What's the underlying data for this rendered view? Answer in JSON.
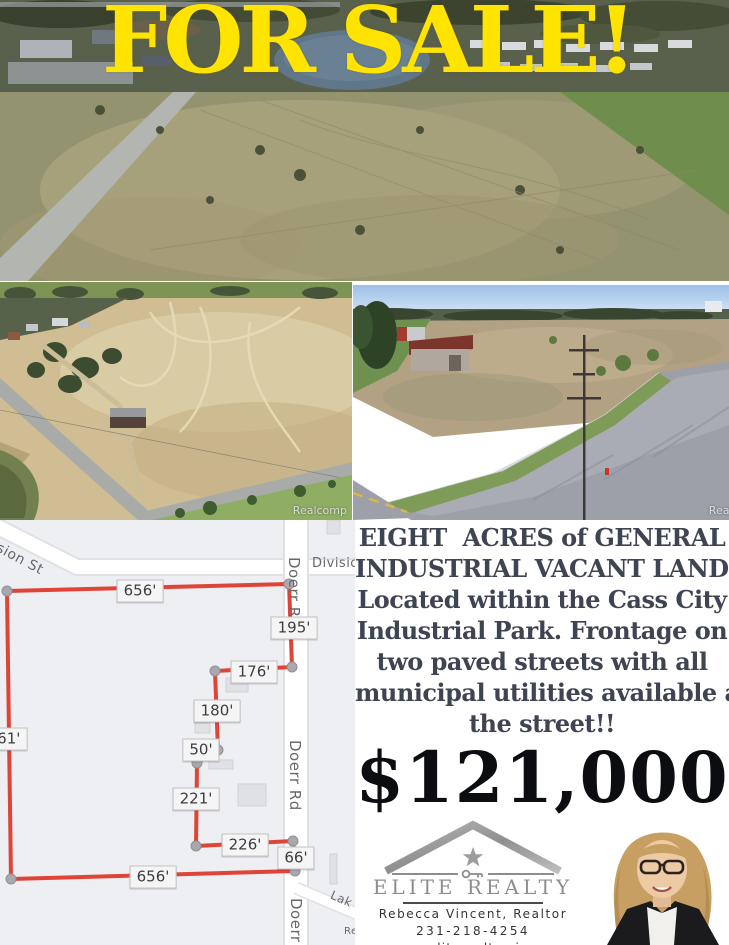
{
  "headline": "FOR SALE!",
  "photos": {
    "watermark": "Realcomp"
  },
  "right_panel": {
    "description_lines": [
      "EIGHT  ACRES of GENERAL",
      "INDUSTRIAL VACANT LAND!",
      "Located within the Cass City",
      "Industrial Park. Frontage on",
      "two paved streets with all",
      "municipal utilities available at",
      "the street!!"
    ],
    "price": "$121,000"
  },
  "brand": {
    "name": "ELITE REALTY",
    "agent": "Rebecca Vincent, Realtor",
    "phone": "231-218-4254",
    "website": "www.eliterealtymi.com"
  },
  "map": {
    "colors": {
      "background": "#edeff2",
      "road": "#ffffff",
      "parcel_line": "#df4437",
      "vertex": "#a8a8ad",
      "building": "#dfe1e4"
    },
    "dimension_labels": [
      {
        "text": "656'",
        "cx": 140,
        "cy": 71
      },
      {
        "text": "195'",
        "cx": 294,
        "cy": 108
      },
      {
        "text": "176'",
        "cx": 254,
        "cy": 152
      },
      {
        "text": "180'",
        "cx": 217,
        "cy": 191
      },
      {
        "text": "50'",
        "cx": 201,
        "cy": 230
      },
      {
        "text": "221'",
        "cx": 196,
        "cy": 279
      },
      {
        "text": "226'",
        "cx": 245,
        "cy": 325
      },
      {
        "text": "66'",
        "cx": 296,
        "cy": 338
      },
      {
        "text": "656'",
        "cx": 153,
        "cy": 357
      },
      {
        "text": "661'",
        "cx": 4,
        "cy": 219
      }
    ],
    "street_labels": [
      {
        "text": "sion St",
        "left": 1,
        "top": 20,
        "rotate": 28,
        "size": 14
      },
      {
        "text": "Divisio",
        "left": 312,
        "top": 36,
        "rotate": 0,
        "size": 13
      },
      {
        "text": "Doerr R",
        "left": 303,
        "top": 37,
        "rotate": 90,
        "size": 15
      },
      {
        "text": "Doerr Rd",
        "left": 304,
        "top": 220,
        "rotate": 90,
        "size": 15
      },
      {
        "text": "Doerr",
        "left": 305,
        "top": 378,
        "rotate": 90,
        "size": 15
      },
      {
        "text": "Lak",
        "left": 334,
        "top": 368,
        "rotate": 24,
        "size": 12
      },
      {
        "text": "Re",
        "left": 344,
        "top": 406,
        "rotate": 0,
        "size": 10
      }
    ],
    "parcel": {
      "stroke": "#df4437",
      "points": [
        [
          7,
          71
        ],
        [
          289,
          64
        ],
        [
          292,
          147
        ],
        [
          215,
          151
        ],
        [
          218,
          230
        ],
        [
          197,
          243
        ],
        [
          196,
          326
        ],
        [
          293,
          321
        ],
        [
          295,
          351
        ],
        [
          11,
          359
        ]
      ]
    },
    "buildings": [
      [
        226,
        158,
        22,
        14
      ],
      [
        209,
        240,
        24,
        9
      ],
      [
        238,
        264,
        28,
        22
      ],
      [
        330,
        334,
        7,
        30
      ],
      [
        327,
        0,
        13,
        14
      ],
      [
        195,
        203,
        15,
        10
      ]
    ]
  }
}
